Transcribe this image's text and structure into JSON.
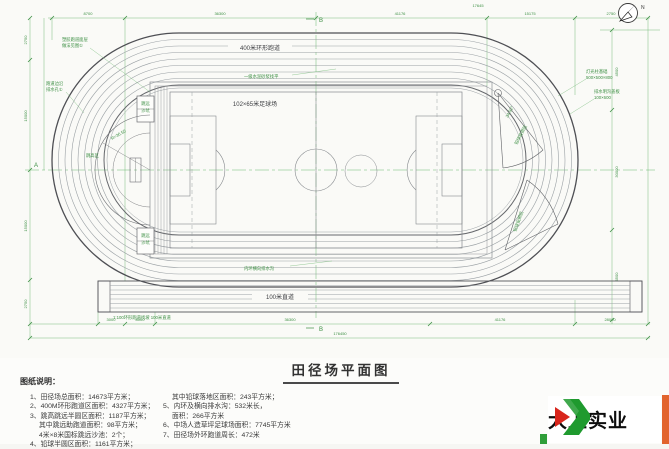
{
  "drawing": {
    "title": "田径场平面图",
    "north_label": "N",
    "labels": {
      "top_straight": "400米环形跑道",
      "field": "102×65米足球场",
      "bottom_straight": "100米直道",
      "inner_top": "一级水泥砂浆找平",
      "inner_bottom": "内环横向排水沟",
      "slope_note": "1:100环形跑道找坡 100米直道",
      "high_jump": "跳高区",
      "high_jump_radius": "R=36.50",
      "sector_angle": "34.92°",
      "sector_top": "铅球投掷区",
      "sector_bottom": "铅球投掷区",
      "pit_line1": "跳远",
      "pit_line2": "沙坑"
    },
    "callouts": {
      "left_top_1": "塑胶跑道面层",
      "left_top_2": "做法见图①",
      "left_mid_1": "跑道边沿",
      "left_mid_2": "排水孔①",
      "right_1a": "灯光柱基础",
      "right_1b": "500×500×800",
      "right_2a": "排水明沟盖板",
      "right_2b": "100×600"
    },
    "markers": {
      "left": "A",
      "top": "B",
      "bottom": "B"
    },
    "dims": {
      "top": [
        "8700",
        "36300",
        "41176",
        "15175",
        "2750"
      ],
      "top_total": "17645",
      "left": [
        "2750",
        "15000",
        "15000",
        "2750"
      ],
      "right": [
        "4500",
        "30000",
        "4500"
      ],
      "bottom": [
        "3000",
        "8000",
        "36300",
        "41176",
        "28000"
      ],
      "bottom_total": "176450"
    }
  },
  "notes": {
    "heading": "图纸说明：",
    "left": [
      "1、田径场总面积：14673平方米；",
      "2、400M环形跑道区面积：4327平方米；",
      "3、跳高跳远半圆区面积：1187平方米；",
      "其中跳远助跑道面积：98平方米；",
      "4米×8米国标跳远沙池：2个；",
      "4、铅球半圆区面积：1161平方米；"
    ],
    "right": [
      "其中铅球落地区面积：243平方米；",
      "5、内环及横向排水沟：532米长，",
      "面积：266平方米",
      "6、中场人造草坪足球场面积：7745平方米",
      "7、田径场外环跑道周长：472米"
    ]
  },
  "logo": {
    "name": "大上实业"
  }
}
